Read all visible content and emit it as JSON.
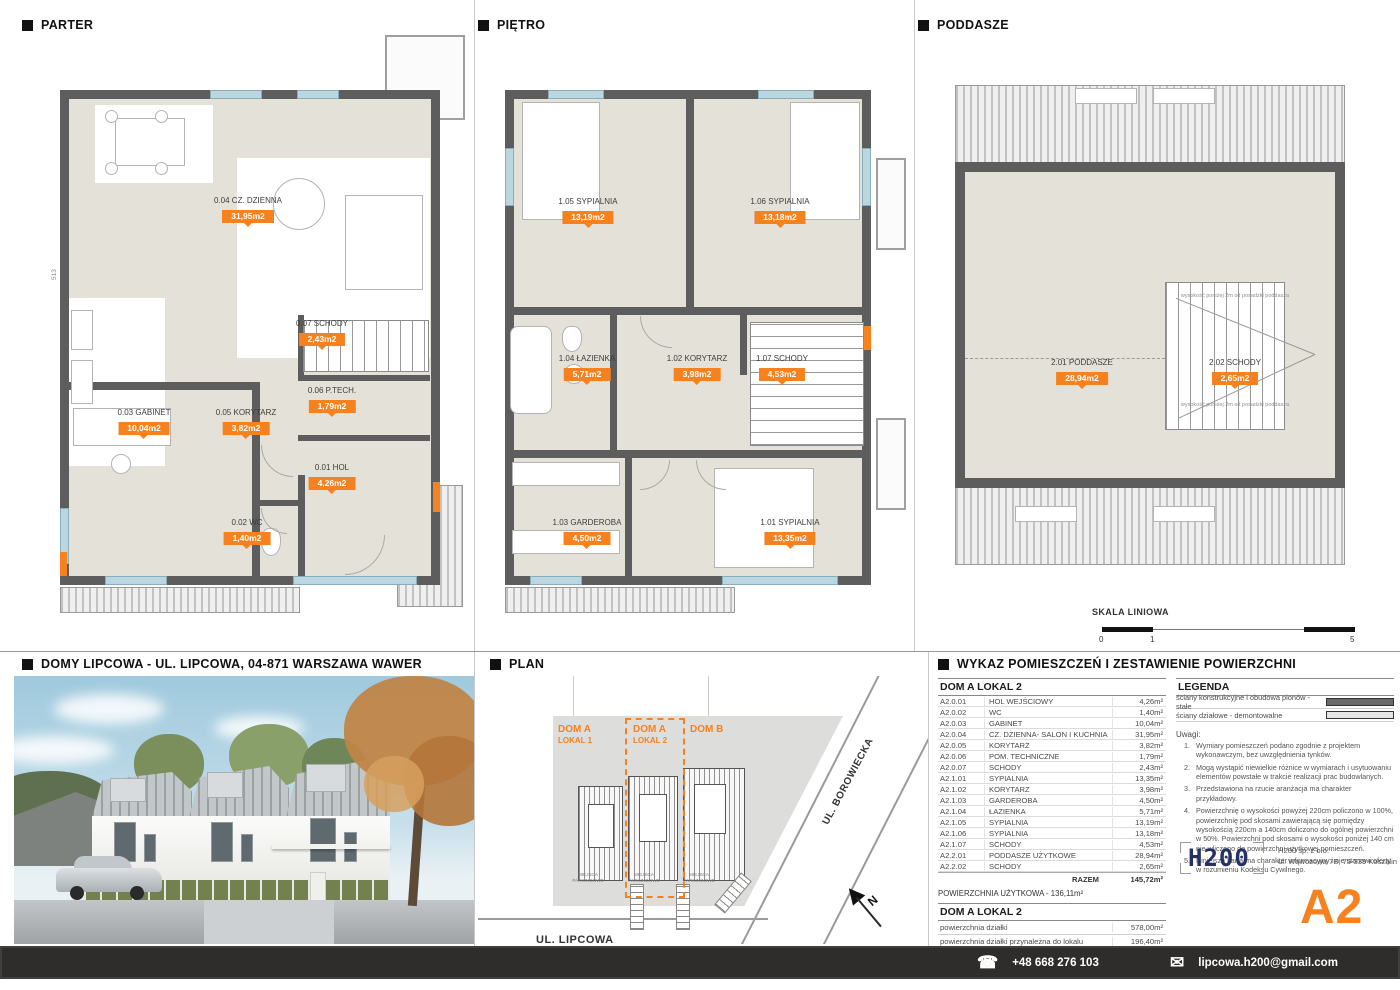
{
  "accent": "#F5821F",
  "headers": {
    "parter": "PARTER",
    "pietro": "PIĘTRO",
    "poddasze": "PODDASZE",
    "photo": "DOMY LIPCOWA - UL. LIPCOWA, 04-871 WARSZAWA WAWER",
    "plan": "PLAN",
    "wykaz": "WYKAZ POMIESZCZEŃ I ZESTAWIENIE POWIERZCHNI"
  },
  "plans": {
    "parter": {
      "rooms": [
        {
          "name": "0.04 CZ. DZIENNA",
          "area": "31,95m2"
        },
        {
          "name": "0.07 SCHODY",
          "area": "2,43m2"
        },
        {
          "name": "0.06 P.TECH.",
          "area": "1,79m2"
        },
        {
          "name": "0.03 GABINET",
          "area": "10,04m2"
        },
        {
          "name": "0.05 KORYTARZ",
          "area": "3,82m2"
        },
        {
          "name": "0.01 HOL",
          "area": "4,26m2"
        },
        {
          "name": "0.02 WC",
          "area": "1,40m2"
        }
      ],
      "dims": [
        "675",
        "513"
      ]
    },
    "pietro": {
      "rooms": [
        {
          "name": "1.05 SYPIALNIA",
          "area": "13,19m2"
        },
        {
          "name": "1.06 SYPIALNIA",
          "area": "13,18m2"
        },
        {
          "name": "1.04 ŁAZIENKA",
          "area": "5,71m2"
        },
        {
          "name": "1.02 KORYTARZ",
          "area": "3,98m2"
        },
        {
          "name": "1.07 SCHODY",
          "area": "4,53m2"
        },
        {
          "name": "1.03 GARDEROBA",
          "area": "4,50m2"
        },
        {
          "name": "1.01 SYPIALNIA",
          "area": "13,35m2"
        }
      ],
      "dims": [
        "332",
        "321"
      ]
    },
    "poddasze": {
      "rooms": [
        {
          "name": "2.01 PODDASZE",
          "area": "28,94m2"
        },
        {
          "name": "2.02 SCHODY",
          "area": "2,65m2"
        }
      ],
      "dims": [
        "370"
      ],
      "annotation": "wysokość poniżej 2m od posadzki poddasza"
    }
  },
  "scale_bar": {
    "title": "SKALA LINIOWA",
    "ticks": [
      "0",
      "1",
      "5"
    ]
  },
  "site_plan": {
    "houses": [
      {
        "line1": "DOM A",
        "line2": "LOKAL 1"
      },
      {
        "line1": "DOM A",
        "line2": "LOKAL 2"
      },
      {
        "line1": "DOM B",
        "line2": ""
      }
    ],
    "parking_label": "MIEJSCA PARKINGOWE",
    "street_bottom": "UL. LIPCOWA",
    "street_right": "UL. BOROWIECKA",
    "north": "N"
  },
  "room_table": {
    "title": "DOM A LOKAL 2",
    "rows": [
      [
        "A2.0.01",
        "HOL WEJŚCIOWY",
        "4,26m²"
      ],
      [
        "A2.0.02",
        "WC",
        "1,40m²"
      ],
      [
        "A2.0.03",
        "GABINET",
        "10,04m²"
      ],
      [
        "A2.0.04",
        "CZ. DZIENNA- SALON I KUCHNIA",
        "31,95m²"
      ],
      [
        "A2.0.05",
        "KORYTARZ",
        "3,82m²"
      ],
      [
        "A2.0.06",
        "POM. TECHNICZNE",
        "1,79m²"
      ],
      [
        "A2.0.07",
        "SCHODY",
        "2,43m²"
      ],
      [
        "A2.1.01",
        "SYPIALNIA",
        "13,35m²"
      ],
      [
        "A2.1.02",
        "KORYTARZ",
        "3,98m²"
      ],
      [
        "A2.1.03",
        "GARDEROBA",
        "4,50m²"
      ],
      [
        "A2.1.04",
        "ŁAZIENKA",
        "5,71m²"
      ],
      [
        "A2.1.05",
        "SYPIALNIA",
        "13,19m²"
      ],
      [
        "A2.1.06",
        "SYPIALNIA",
        "13,18m²"
      ],
      [
        "A2.1.07",
        "SCHODY",
        "4,53m²"
      ],
      [
        "A2.2.01",
        "PODDASZE UŻYTKOWE",
        "28,94m²"
      ],
      [
        "A2.2.02",
        "SCHODY",
        "2,65m²"
      ]
    ],
    "total_label": "RAZEM",
    "total_value": "145,72m²",
    "usable_area": "POWIERZCHNIA UŻYTKOWA - 136,11m²",
    "plot_title": "DOM A LOKAL 2",
    "plot_rows": [
      [
        "powierzchnia działki",
        "578,00m²"
      ],
      [
        "powierzchnia działki przynależna do lokalu",
        "196,40m²"
      ],
      [
        "powierzchnia ogródka (teren nieutwardzony)",
        "79,30m²"
      ]
    ]
  },
  "legend": {
    "title": "LEGENDA",
    "items": [
      {
        "label": "ściany konstrukcyjne i obudowa pionów - stałe",
        "color": "#6a6a6a"
      },
      {
        "label": "ściany działowe - demontowalne",
        "color": "#e6e6e6"
      }
    ],
    "notes_title": "Uwagi:",
    "notes": [
      "Wymiary pomieszczeń podano zgodnie z projektem wykonawczym, bez uwzględnienia tynków.",
      "Mogą wystąpić niewielkie różnice w wymiarach i usytuowaniu elementów powstałe w trakcie realizacji prac budowlanych.",
      "Przedstawiona na rzucie aranżacja ma charakter przykładowy.",
      "Powierzchnię o wysokości powyżej 220cm policzono w 100%, powierzchnię pod skosami zawierającą się pomiędzy wysokością 220cm a 140cm doliczono do ogólnej powierzchni w 50%. Powierzchni pod skosami o wysokości poniżej 140 cm nie wliczono do powierzchni użytkowej pomieszczeń.",
      "Niniejsza karta ma charakter informacyjny i nie stanowi oferty w rozumieniu Kodeksu Cywilnego."
    ]
  },
  "company": {
    "logo": "H200",
    "name": "H200 sp. z o.o.",
    "address": "ul. Wąwozowa 7B, 75-339 Koszalin"
  },
  "sheet_code": "A2",
  "footer": {
    "phone": "+48 668 276 103",
    "email": "lipcowa.h200@gmail.com"
  }
}
